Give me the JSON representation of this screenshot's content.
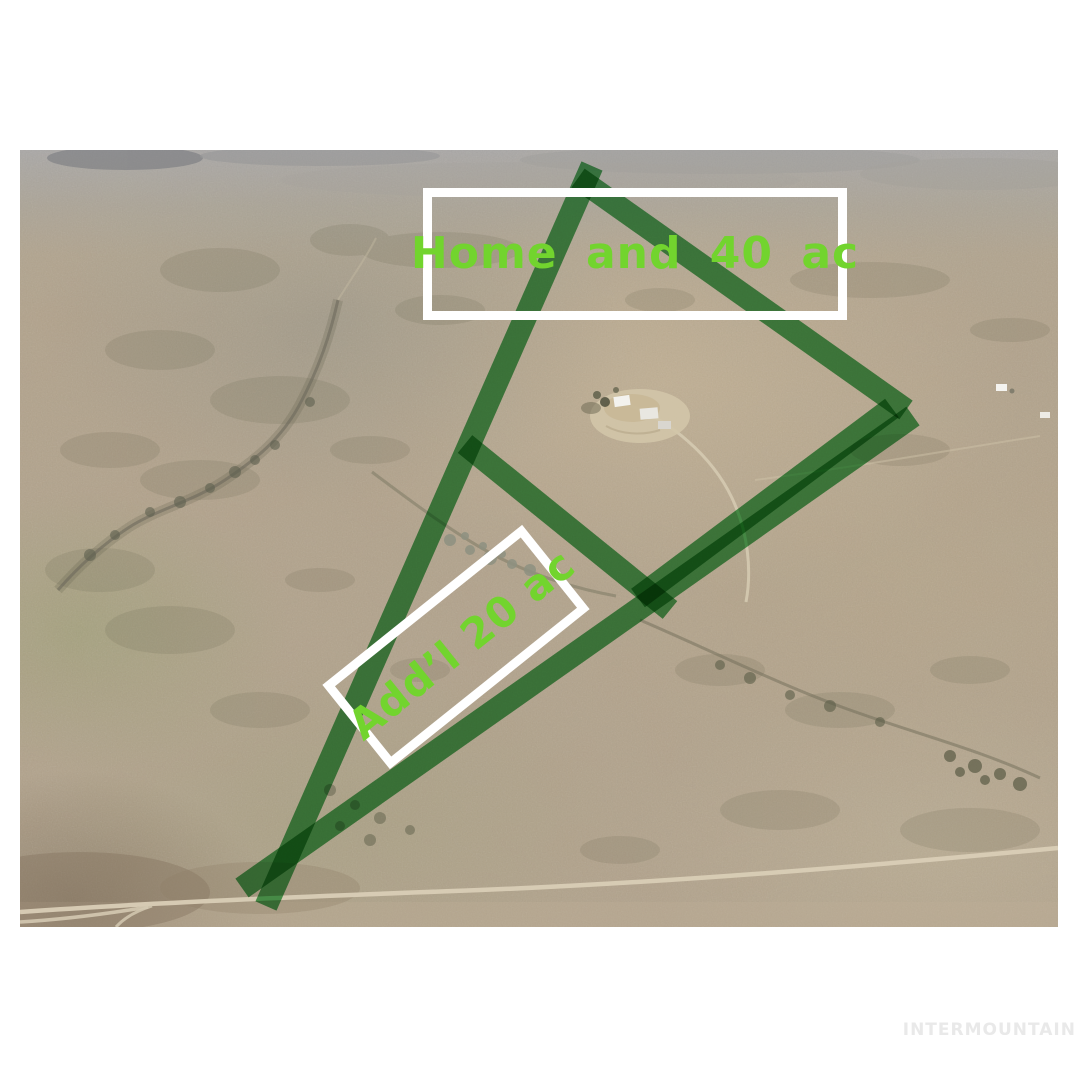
{
  "labels": {
    "home_parcel": "Home and 40 ac",
    "additional_parcel": "Add’l 20 ac"
  },
  "watermark": {
    "text": "INTERMOUNTAIN"
  },
  "colors": {
    "boundary_green": "#35a047",
    "label_text_green": "#72d42e",
    "label_box_border": "#ffffff",
    "watermark_gray": "#e9e9e9",
    "page_background": "#ffffff"
  }
}
